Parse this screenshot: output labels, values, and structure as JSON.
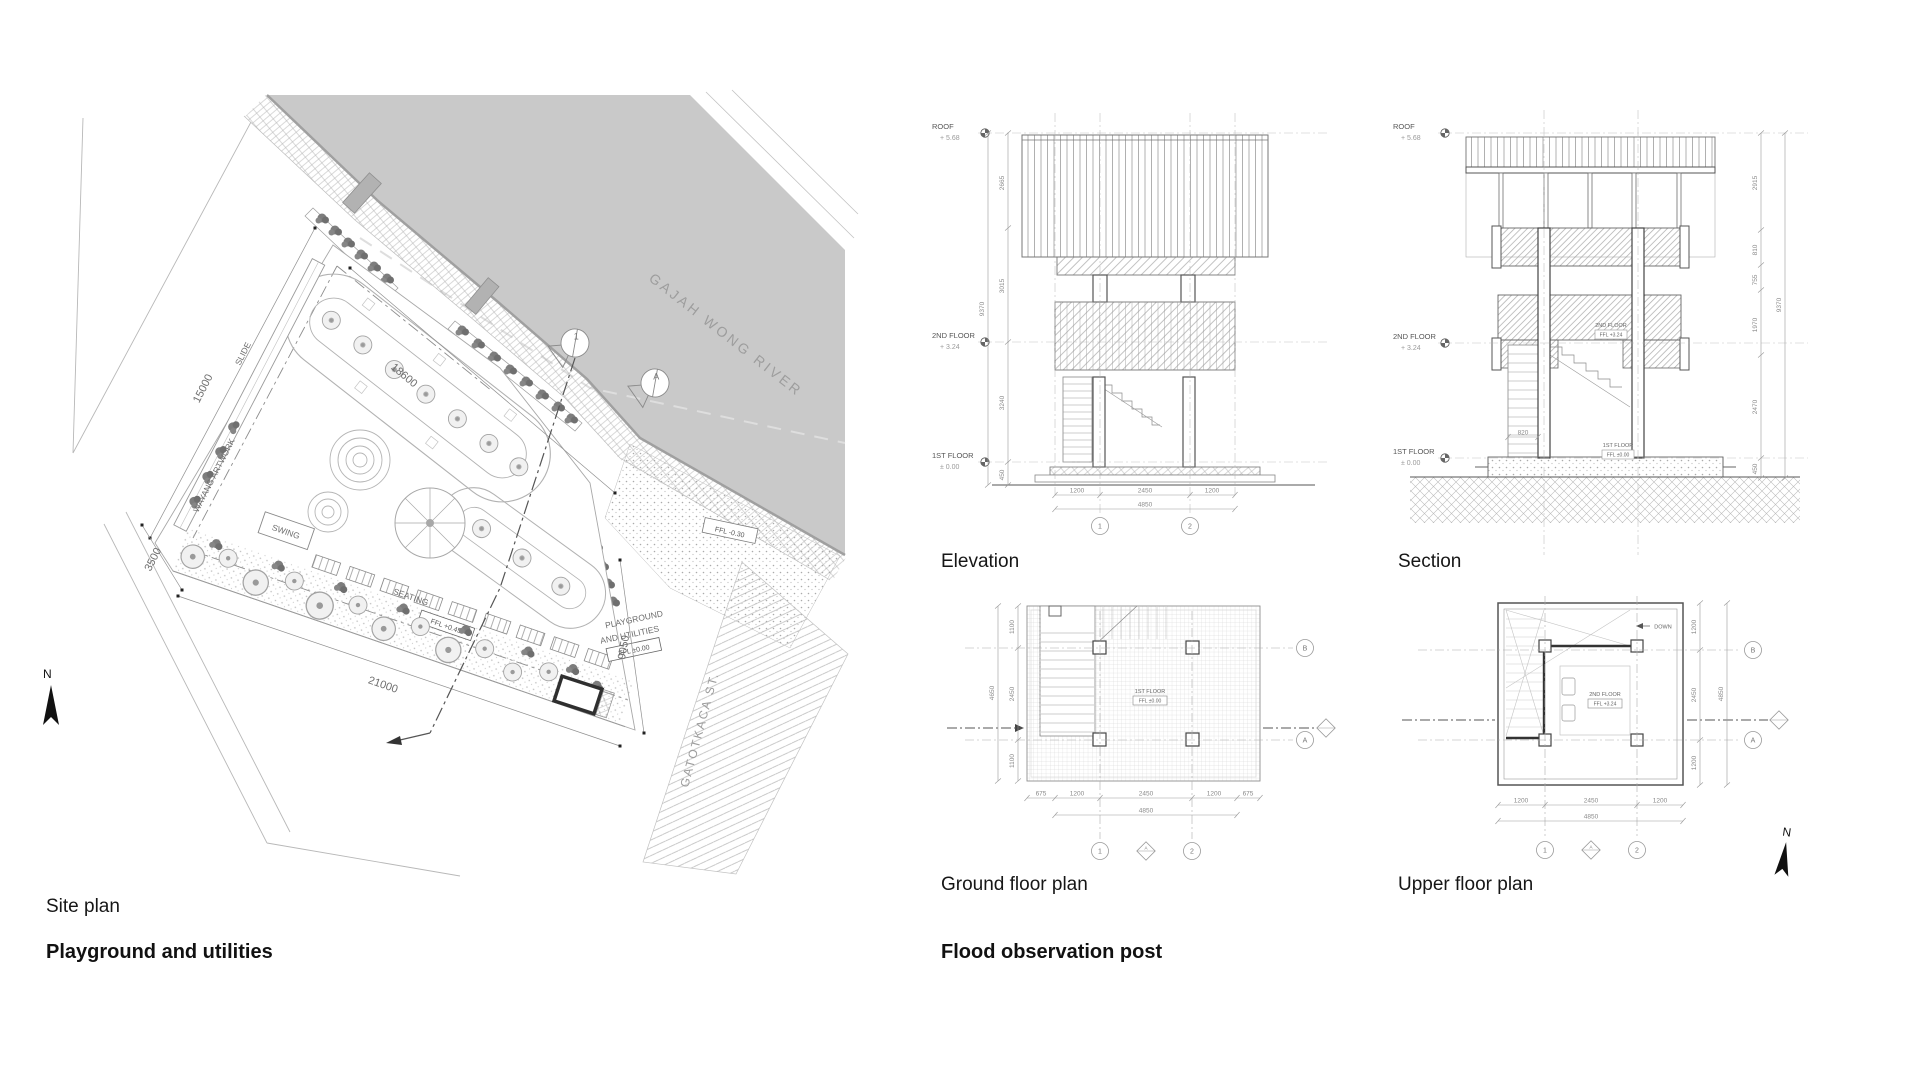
{
  "captions": {
    "site_plan": "Site plan",
    "site_title": "Playground and utilities",
    "elevation": "Elevation",
    "section": "Section",
    "ground_floor": "Ground floor plan",
    "upper_floor": "Upper floor plan",
    "right_title": "Flood observation post"
  },
  "colors": {
    "river": "#c9c9c9",
    "paper": "#ffffff",
    "ink": "#1a1a1a",
    "line": "#9a9a9a"
  },
  "site": {
    "river_label": "GAJAH WONG RIVER",
    "street_label": "GATOTKACA ST.",
    "north": "N",
    "wayang": "WAYANG ARTWORK",
    "slide": "SLIDE",
    "swing": "SWING",
    "seating": "SEATING",
    "area_line1": "PLAYGROUND",
    "area_line2": "AND UTILITIES",
    "ffl_area": "FFL ±0.00",
    "ffl_seating": "FFL +0.45",
    "ffl_plaza": "FFL -0.30",
    "dim_nw": "15000",
    "dim_river": "18600",
    "dim_w": "3500",
    "dim_s": "21000",
    "dim_e": "9050",
    "marker_1": "1",
    "marker_a": "A"
  },
  "elevation": {
    "levels": {
      "roof": "ROOF",
      "roof_v": "+ 5.68",
      "f2": "2ND FLOOR",
      "f2_v": "+ 3.24",
      "f1": "1ST FLOOR",
      "f1_v": "± 0.00"
    },
    "dims_v": [
      "2665",
      "3015",
      "3240",
      "450"
    ],
    "dim_v_total": "9370",
    "dims_h": [
      "1200",
      "2450",
      "1200"
    ],
    "dim_h_total": "4850",
    "grid": [
      "1",
      "2"
    ]
  },
  "section": {
    "levels": {
      "roof": "ROOF",
      "roof_v": "+ 5.68",
      "f2": "2ND FLOOR",
      "f2_v": "+ 3.24",
      "f1": "1ST FLOOR",
      "f1_v": "± 0.00"
    },
    "dims_v": [
      "2915",
      "810",
      "755",
      "1970",
      "2470",
      "450"
    ],
    "dim_v_total": "9370",
    "stair_dim": "820",
    "int_f2_a": "2ND FLOOR",
    "int_f2_b": "FFL +3.24",
    "int_f1_a": "1ST FLOOR",
    "int_f1_b": "FFL ±0.00"
  },
  "ground": {
    "tag_a": "1ST FLOOR",
    "tag_b": "FFL ±0.00",
    "dims_left": [
      "1100",
      "2450",
      "1100"
    ],
    "dims_left_total": "4650",
    "dims_bottom": [
      "675",
      "1200",
      "2450",
      "1200",
      "675"
    ],
    "dims_bottom_total": "4850",
    "grid_h": [
      "B",
      "A"
    ],
    "grid_v": [
      "1",
      "2"
    ],
    "marker": "A"
  },
  "upper": {
    "tag_a": "2ND FLOOR",
    "tag_b": "FFL +3.24",
    "down": "DOWN",
    "dims_right": [
      "1200",
      "2450",
      "1200"
    ],
    "dims_right_total": "4850",
    "dims_bottom": [
      "1200",
      "2450",
      "1200"
    ],
    "dims_bottom_total": "4850",
    "grid_h": [
      "B",
      "A"
    ],
    "grid_v": [
      "1",
      "2"
    ],
    "marker": "A",
    "north": "N"
  }
}
